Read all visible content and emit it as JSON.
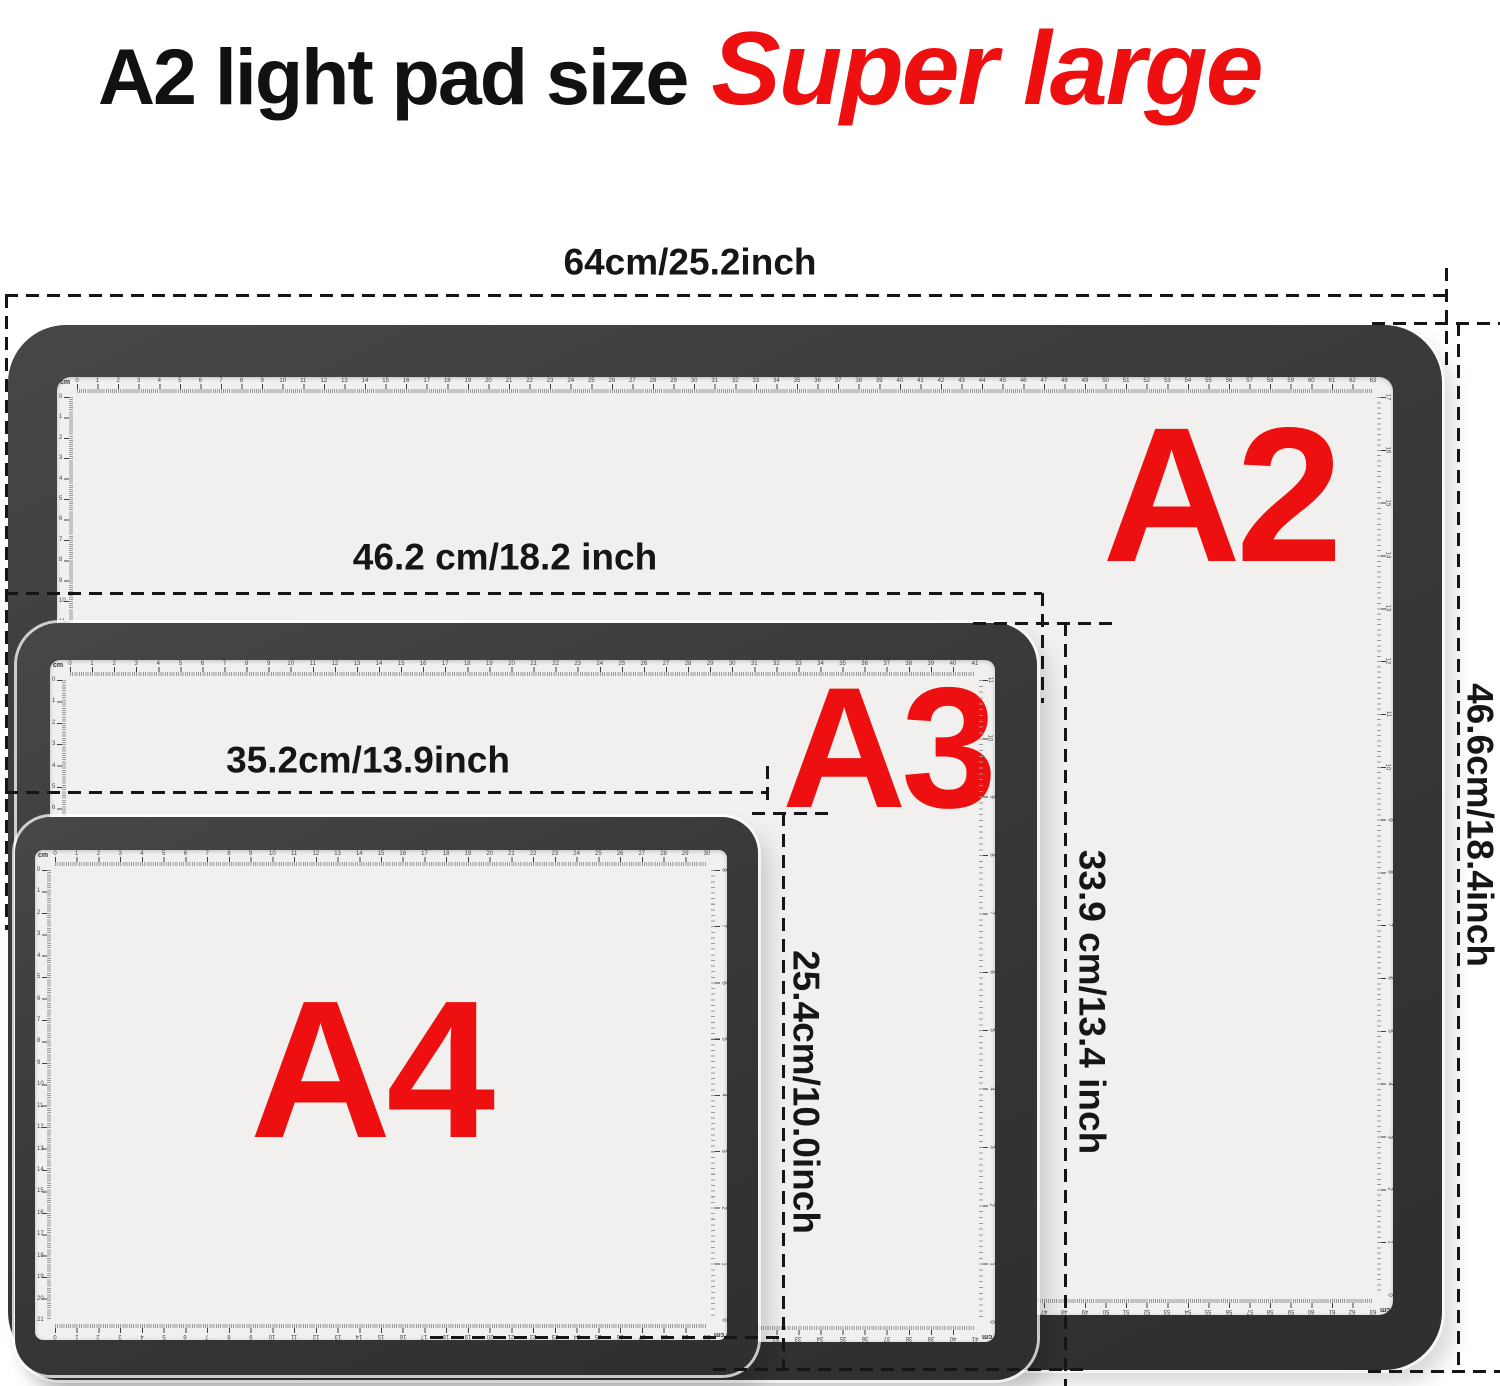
{
  "title": {
    "black": "A2 light pad size",
    "red": "Super large"
  },
  "colors": {
    "accent_red": "#ee1010",
    "frame": "#383838",
    "interior": "#f1f0ee",
    "dash": "#151515",
    "background": "#ffffff"
  },
  "pads": [
    {
      "id": "a2",
      "label": "A2",
      "unit": "cm",
      "rulers": {
        "top_count": 63,
        "bottom_count": 63,
        "left_count": 44,
        "right_count": 17
      }
    },
    {
      "id": "a3",
      "label": "A3",
      "unit": "cm",
      "rulers": {
        "top_count": 41,
        "bottom_count": 41,
        "left_count": 30,
        "right_count": 11
      }
    },
    {
      "id": "a4",
      "label": "A4",
      "unit": "cm",
      "rulers": {
        "top_count": 30,
        "bottom_count": 30,
        "left_count": 21,
        "right_count": 8
      }
    }
  ],
  "measurements": {
    "a2_width": "64cm/25.2inch",
    "a2_height": "46.6cm/18.4inch",
    "a2_lit_width": "46.2 cm/18.2 inch",
    "a2_lit_height": "33.9 cm/13.4 inch",
    "a3_lit_width": "35.2cm/13.9inch",
    "a3_lit_height": "25.4cm/10.0inch"
  }
}
